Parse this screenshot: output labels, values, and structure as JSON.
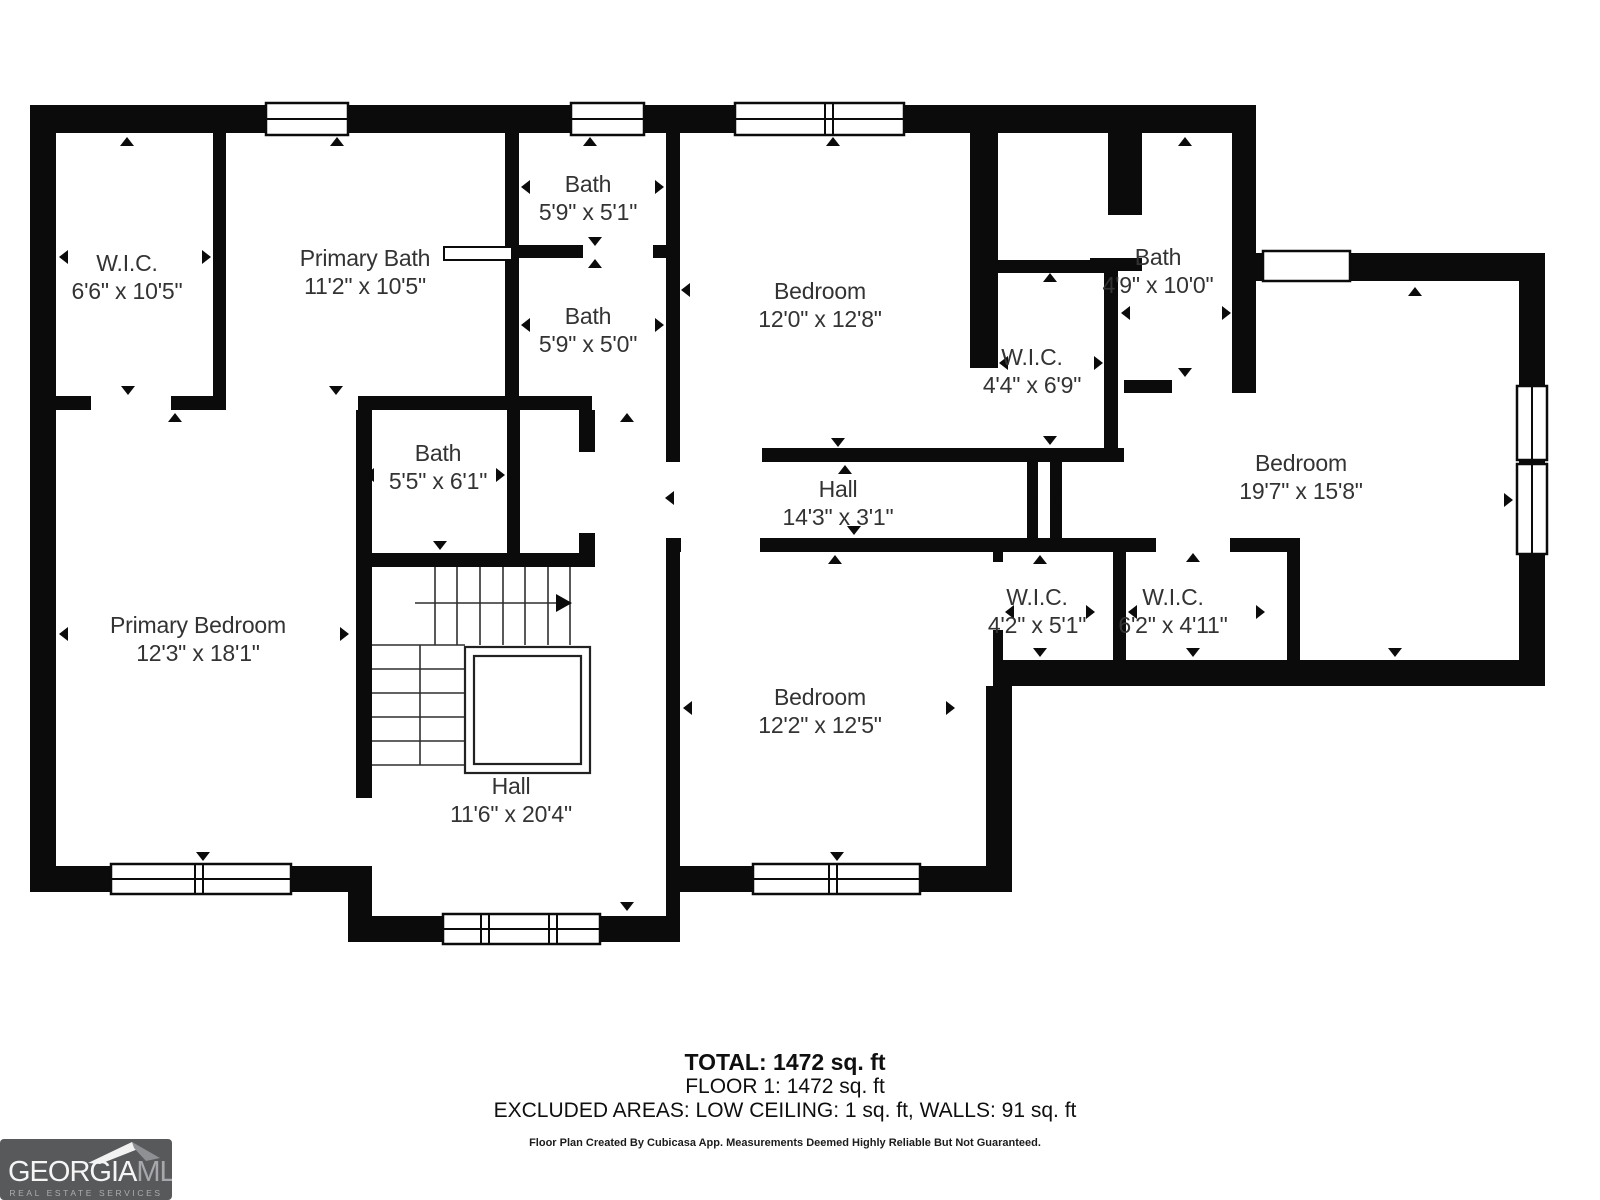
{
  "rooms": [
    {
      "name": "W.I.C.",
      "dims": "6'6\" x 10'5\""
    },
    {
      "name": "Primary Bath",
      "dims": "11'2\" x 10'5\""
    },
    {
      "name": "Bath",
      "dims": "5'9\" x 5'1\""
    },
    {
      "name": "Bath",
      "dims": "5'9\" x 5'0\""
    },
    {
      "name": "Bedroom",
      "dims": "12'0\" x 12'8\""
    },
    {
      "name": "Bath",
      "dims": "4'9\" x 10'0\""
    },
    {
      "name": "W.I.C.",
      "dims": "4'4\" x 6'9\""
    },
    {
      "name": "Bedroom",
      "dims": "19'7\" x 15'8\""
    },
    {
      "name": "Bath",
      "dims": "5'5\" x 6'1\""
    },
    {
      "name": "Hall",
      "dims": "14'3\" x 3'1\""
    },
    {
      "name": "Primary Bedroom",
      "dims": "12'3\" x 18'1\""
    },
    {
      "name": "W.I.C.",
      "dims": "4'2\" x 5'1\""
    },
    {
      "name": "W.I.C.",
      "dims": "6'2\" x 4'11\""
    },
    {
      "name": "Bedroom",
      "dims": "12'2\" x 12'5\""
    },
    {
      "name": "Hall",
      "dims": "11'6\" x 20'4\""
    }
  ],
  "summary": {
    "total": "TOTAL: 1472 sq. ft",
    "floor": "FLOOR 1: 1472 sq. ft",
    "excluded": "EXCLUDED AREAS: LOW CEILING: 1 sq. ft, WALLS: 91 sq. ft",
    "disclaimer": "Floor Plan Created By Cubicasa App. Measurements Deemed Highly Reliable But Not Guaranteed."
  },
  "brand": {
    "line1": "GEORGIA",
    "line2": "MLS",
    "tagline": "REAL ESTATE SERVICES"
  },
  "colors": {
    "wall": "#0b0b0b",
    "background": "#ffffff",
    "label_text": "#333333",
    "brand_bg": "#58595b",
    "brand_text_secondary": "#a6a8ab"
  }
}
